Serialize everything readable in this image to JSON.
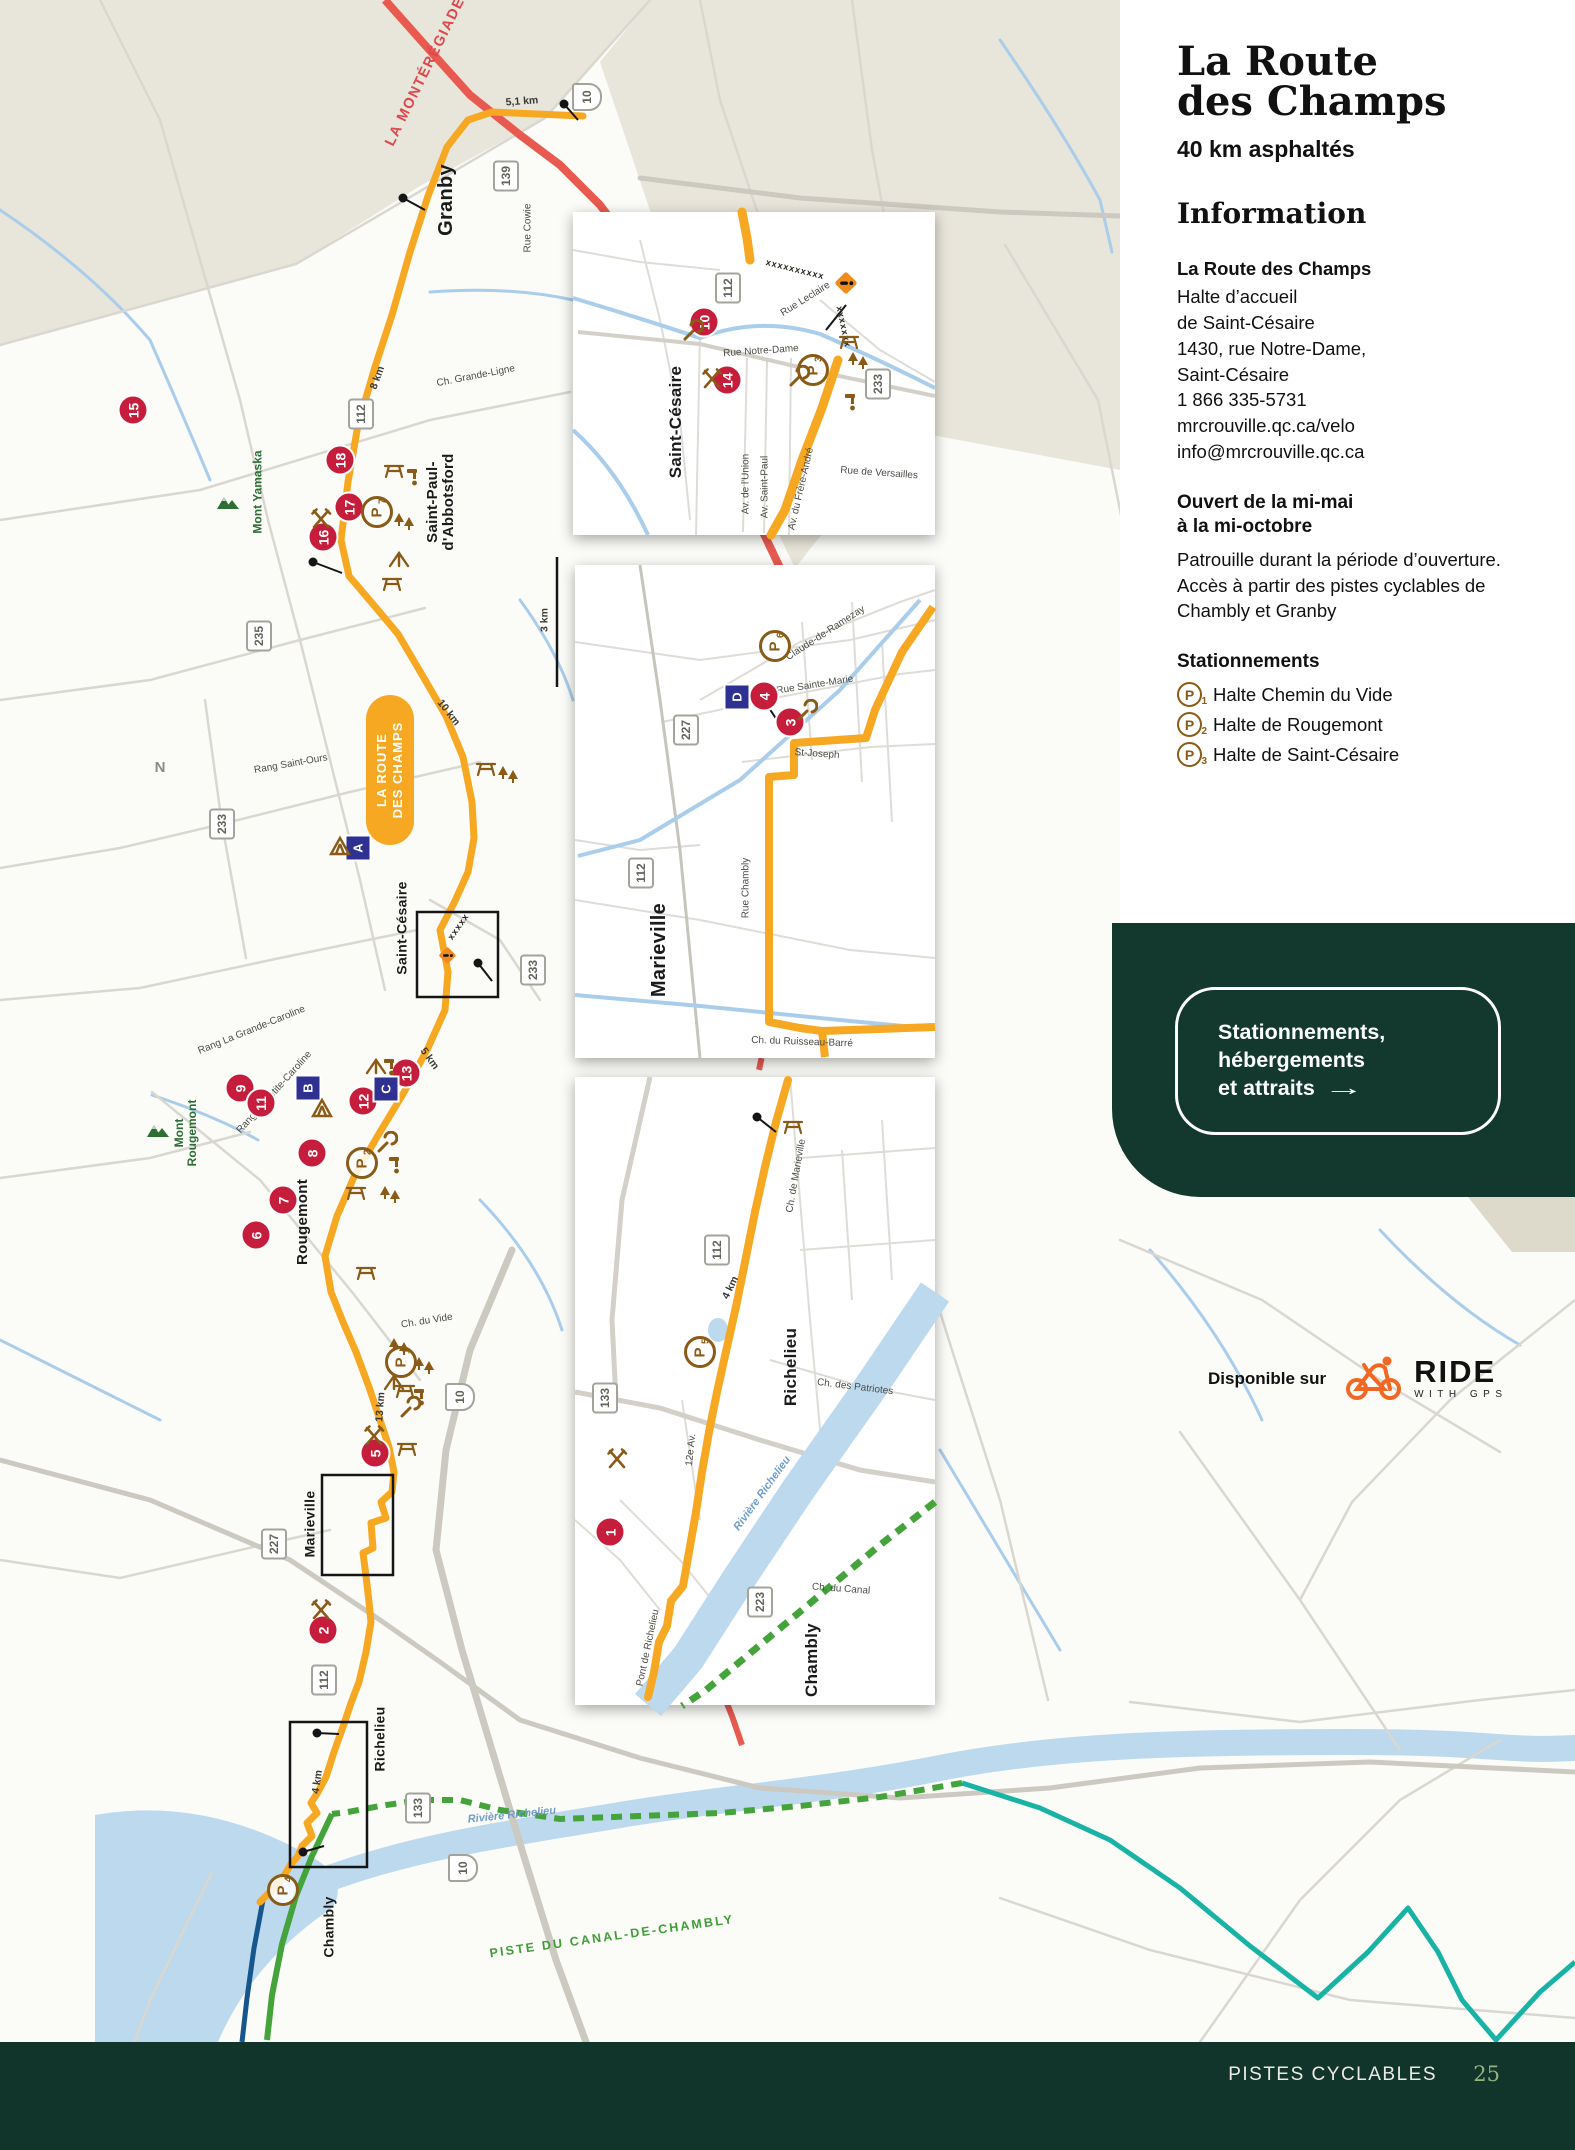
{
  "page": {
    "footer": {
      "section": "PISTES CYCLABLES",
      "page_number": "25"
    }
  },
  "panel": {
    "title": "La Route\ndes Champs",
    "subtitle": "40 km asphaltés",
    "info_heading": "Information",
    "info_name": "La Route des Champs",
    "address": "Halte d’accueil\nde Saint-Césaire\n1430, rue Notre-Dame,\nSaint-Césaire",
    "phone": "1 866 335-5731",
    "website": "mrcrouville.qc.ca/velo",
    "email": "info@mrcrouville.qc.ca",
    "open_heading": "Ouvert de la mi-mai\nà la mi-octobre",
    "open_body": "Patrouille durant la période d’ouverture. Accès à partir des pistes cyclables de Chambly et Granby",
    "parking_heading": "Stationnements",
    "parking_items": [
      {
        "num": "1",
        "label": "Halte Chemin du Vide"
      },
      {
        "num": "2",
        "label": "Halte de Rougemont"
      },
      {
        "num": "3",
        "label": "Halte de Saint-Césaire"
      }
    ],
    "cta": {
      "label": "Stationnements,\nhébergements\net attraits",
      "arrow": "→"
    },
    "ridewithgps": {
      "prefix": "Disponible sur",
      "brand": "RIDE",
      "sub": "WITH GPS"
    }
  },
  "map": {
    "badge": {
      "line1": "LA ROUTE",
      "line2": "DES CHAMPS"
    },
    "accent_colors": {
      "route_orange": "#f7a823",
      "monteregiade_red": "#e85a50",
      "canal_green": "#45a33c",
      "teal": "#19b3a6",
      "navy": "#17568c",
      "marker_red": "#c51d3b",
      "marker_blue": "#2e3192",
      "icon_brown": "#8a5a17",
      "dark_green": "#13382e"
    },
    "labels": [
      {
        "t": "LA MONTÉRÉGIADE",
        "x": 426,
        "y": 72,
        "r": -64,
        "c": "rlabel",
        "n": "route-label-monteregiade"
      },
      {
        "t": "PISTE DU CANAL-DE-CHAMBLY",
        "x": 612,
        "y": 1937,
        "r": -8,
        "c": "glabel",
        "n": "route-label-canal-chambly"
      },
      {
        "t": "Granby",
        "x": 447,
        "y": 200,
        "r": -90,
        "c": "city",
        "s": 20,
        "n": "city-granby"
      },
      {
        "t": "Saint-Paul-\nd'Abbotsford",
        "x": 441,
        "y": 502,
        "r": -90,
        "c": "city",
        "s": 15,
        "n": "city-saint-paul-abbotsford"
      },
      {
        "t": "Saint-Césaire",
        "x": 402,
        "y": 928,
        "r": -90,
        "c": "city",
        "s": 14,
        "n": "city-saint-cesaire"
      },
      {
        "t": "Rougemont",
        "x": 303,
        "y": 1222,
        "r": -90,
        "c": "city",
        "s": 15,
        "n": "city-rougemont"
      },
      {
        "t": "Marieville",
        "x": 310,
        "y": 1524,
        "r": -90,
        "c": "city",
        "s": 14,
        "n": "city-marieville"
      },
      {
        "t": "Richelieu",
        "x": 380,
        "y": 1739,
        "r": -90,
        "c": "city",
        "s": 14,
        "n": "city-richelieu"
      },
      {
        "t": "Chambly",
        "x": 329,
        "y": 1927,
        "r": -90,
        "c": "city",
        "s": 14,
        "n": "city-chambly"
      },
      {
        "t": "Saint-Césaire",
        "x": 676,
        "y": 422,
        "r": -90,
        "c": "city",
        "s": 17,
        "n": "inset1-city-saint-cesaire"
      },
      {
        "t": "Marieville",
        "x": 660,
        "y": 950,
        "r": -90,
        "c": "city",
        "s": 20,
        "n": "inset2-city-marieville"
      },
      {
        "t": "Richelieu",
        "x": 791,
        "y": 1367,
        "r": -90,
        "c": "city",
        "s": 17,
        "n": "inset3-city-richelieu"
      },
      {
        "t": "Chambly",
        "x": 812,
        "y": 1660,
        "r": -90,
        "c": "city",
        "s": 17,
        "n": "inset3-city-chambly"
      },
      {
        "t": "Mont Yamaska",
        "x": 258,
        "y": 492,
        "r": -90,
        "c": "mount",
        "n": "mont-yamaska-label"
      },
      {
        "t": "Mont\nRougemont",
        "x": 186,
        "y": 1133,
        "r": -90,
        "c": "mount",
        "n": "mont-rougemont-label"
      },
      {
        "t": "Rue Cowie",
        "x": 529,
        "y": 228,
        "r": -90,
        "c": "street"
      },
      {
        "t": "Ch. Grande-Ligne",
        "x": 476,
        "y": 377,
        "r": -11,
        "c": "street"
      },
      {
        "t": "Rang Saint-Ours",
        "x": 291,
        "y": 765,
        "r": -10,
        "c": "street"
      },
      {
        "t": "Rang La Grande-Caroline",
        "x": 252,
        "y": 1031,
        "r": -22,
        "c": "street"
      },
      {
        "t": "Rang La Petite-Caroline",
        "x": 275,
        "y": 1093,
        "r": -48,
        "c": "street"
      },
      {
        "t": "Ch. du Vide",
        "x": 427,
        "y": 1322,
        "r": -9,
        "c": "street"
      },
      {
        "t": "Rue Notre-Dame",
        "x": 761,
        "y": 352,
        "r": -4,
        "c": "street"
      },
      {
        "t": "Rue Leclaire",
        "x": 806,
        "y": 300,
        "r": -32,
        "c": "street"
      },
      {
        "t": "Av. de l'Union",
        "x": 747,
        "y": 484,
        "r": -90,
        "c": "street"
      },
      {
        "t": "Av. Saint-Paul",
        "x": 766,
        "y": 487,
        "r": -90,
        "c": "street"
      },
      {
        "t": "Av. du Frère-André",
        "x": 802,
        "y": 489,
        "r": -77,
        "c": "street"
      },
      {
        "t": "Rue de Versailles",
        "x": 879,
        "y": 474,
        "r": 4,
        "c": "street"
      },
      {
        "t": "Claude-de-Ramezay",
        "x": 826,
        "y": 634,
        "r": -33,
        "c": "street"
      },
      {
        "t": "Rue Sainte-Marie",
        "x": 815,
        "y": 686,
        "r": -9,
        "c": "street"
      },
      {
        "t": "St-Joseph",
        "x": 817,
        "y": 755,
        "r": 4,
        "c": "street"
      },
      {
        "t": "Rue Chambly",
        "x": 747,
        "y": 888,
        "r": -90,
        "c": "street"
      },
      {
        "t": "Ch. du Ruisseau-Barré",
        "x": 802,
        "y": 1043,
        "r": 2,
        "c": "street"
      },
      {
        "t": "Ch. de Marieville",
        "x": 797,
        "y": 1176,
        "r": -80,
        "c": "street"
      },
      {
        "t": "Ch. des Patriotes",
        "x": 855,
        "y": 1388,
        "r": 7,
        "c": "street"
      },
      {
        "t": "12e Av.",
        "x": 692,
        "y": 1450,
        "r": -84,
        "c": "street"
      },
      {
        "t": "Pont de Richelieu",
        "x": 649,
        "y": 1648,
        "r": -78,
        "c": "street"
      },
      {
        "t": "Ch. du Canal",
        "x": 841,
        "y": 1590,
        "r": 4,
        "c": "street"
      },
      {
        "t": "5,1 km",
        "x": 522,
        "y": 102,
        "r": -4,
        "c": "dist"
      },
      {
        "t": "8 km",
        "x": 378,
        "y": 378,
        "r": -70,
        "c": "dist"
      },
      {
        "t": "10 km",
        "x": 448,
        "y": 713,
        "r": 52,
        "c": "dist"
      },
      {
        "t": "3 km",
        "x": 545,
        "y": 620,
        "r": -90,
        "c": "dist"
      },
      {
        "t": "5 km",
        "x": 429,
        "y": 1059,
        "r": 54,
        "c": "dist"
      },
      {
        "t": "13 km",
        "x": 381,
        "y": 1407,
        "r": -86,
        "c": "dist"
      },
      {
        "t": "4 km",
        "x": 318,
        "y": 1782,
        "r": -82,
        "c": "dist"
      },
      {
        "t": "4 km",
        "x": 731,
        "y": 1288,
        "r": -64,
        "c": "dist"
      },
      {
        "t": "Rivière Richelieu",
        "x": 512,
        "y": 1816,
        "r": -6,
        "c": "water"
      },
      {
        "t": "Rivière Richelieu",
        "x": 763,
        "y": 1494,
        "r": -54,
        "c": "water"
      },
      {
        "t": "N",
        "x": 160,
        "y": 768,
        "r": 0,
        "c": "compass",
        "n": "compass-north"
      },
      {
        "t": "xxxxxxxxxx",
        "x": 795,
        "y": 270,
        "r": 14,
        "c": "xchain",
        "n": "construction-section"
      },
      {
        "t": "xxxxxxx",
        "x": 843,
        "y": 327,
        "r": 78,
        "c": "xchain",
        "n": "construction-section"
      },
      {
        "t": "xxxxx",
        "x": 459,
        "y": 927,
        "r": -55,
        "c": "xchain",
        "n": "construction-section"
      }
    ],
    "numbered_markers": [
      {
        "n": "1",
        "x": 610,
        "y": 1532
      },
      {
        "n": "2",
        "x": 323,
        "y": 1630
      },
      {
        "n": "3",
        "x": 790,
        "y": 722
      },
      {
        "n": "4",
        "x": 764,
        "y": 696
      },
      {
        "n": "5",
        "x": 375,
        "y": 1453
      },
      {
        "n": "6",
        "x": 256,
        "y": 1235
      },
      {
        "n": "7",
        "x": 283,
        "y": 1200
      },
      {
        "n": "8",
        "x": 312,
        "y": 1153
      },
      {
        "n": "9",
        "x": 240,
        "y": 1088
      },
      {
        "n": "10",
        "x": 704,
        "y": 322
      },
      {
        "n": "11",
        "x": 261,
        "y": 1103
      },
      {
        "n": "12",
        "x": 363,
        "y": 1101
      },
      {
        "n": "13",
        "x": 406,
        "y": 1073
      },
      {
        "n": "14",
        "x": 727,
        "y": 380
      },
      {
        "n": "15",
        "x": 133,
        "y": 410
      },
      {
        "n": "16",
        "x": 323,
        "y": 537
      },
      {
        "n": "17",
        "x": 349,
        "y": 507
      },
      {
        "n": "18",
        "x": 340,
        "y": 460
      }
    ],
    "letter_markers": [
      {
        "n": "A",
        "x": 358,
        "y": 848
      },
      {
        "n": "B",
        "x": 308,
        "y": 1088
      },
      {
        "n": "C",
        "x": 386,
        "y": 1089
      },
      {
        "n": "D",
        "x": 737,
        "y": 697
      }
    ],
    "parking_markers": [
      {
        "n": "1",
        "x": 401,
        "y": 1362
      },
      {
        "n": "2",
        "x": 362,
        "y": 1163
      },
      {
        "n": "3",
        "x": 813,
        "y": 370
      },
      {
        "n": "4",
        "x": 283,
        "y": 1890
      },
      {
        "n": "5",
        "x": 700,
        "y": 1352
      },
      {
        "n": "6",
        "x": 775,
        "y": 646
      },
      {
        "n": "7",
        "x": 377,
        "y": 512
      }
    ],
    "shields": [
      {
        "t": "139",
        "x": 506,
        "y": 176
      },
      {
        "t": "112",
        "x": 361,
        "y": 414
      },
      {
        "t": "235",
        "x": 259,
        "y": 636
      },
      {
        "t": "233",
        "x": 222,
        "y": 824
      },
      {
        "t": "233",
        "x": 533,
        "y": 970
      },
      {
        "t": "112",
        "x": 324,
        "y": 1680
      },
      {
        "t": "227",
        "x": 274,
        "y": 1544
      },
      {
        "t": "133",
        "x": 418,
        "y": 1808
      },
      {
        "t": "112",
        "x": 728,
        "y": 288
      },
      {
        "t": "233",
        "x": 878,
        "y": 384
      },
      {
        "t": "227",
        "x": 686,
        "y": 730
      },
      {
        "t": "112",
        "x": 641,
        "y": 873
      },
      {
        "t": "112",
        "x": 717,
        "y": 1250
      },
      {
        "t": "133",
        "x": 605,
        "y": 1398
      },
      {
        "t": "223",
        "x": 760,
        "y": 1602
      },
      {
        "t": "10",
        "x": 587,
        "y": 97,
        "auto": true
      },
      {
        "t": "10",
        "x": 460,
        "y": 1397,
        "auto": true
      },
      {
        "t": "10",
        "x": 463,
        "y": 1868,
        "auto": true
      }
    ],
    "icons": [
      {
        "k": "food",
        "x": 321,
        "y": 519
      },
      {
        "k": "food",
        "x": 712,
        "y": 379
      },
      {
        "k": "food",
        "x": 374,
        "y": 1436
      },
      {
        "k": "food",
        "x": 321,
        "y": 1610
      },
      {
        "k": "food",
        "x": 617,
        "y": 1459
      },
      {
        "k": "wrench",
        "x": 692,
        "y": 331
      },
      {
        "k": "wrench",
        "x": 798,
        "y": 377
      },
      {
        "k": "wrench",
        "x": 806,
        "y": 711
      },
      {
        "k": "wrench",
        "x": 386,
        "y": 1143
      },
      {
        "k": "wrench",
        "x": 409,
        "y": 1408
      },
      {
        "k": "picnic",
        "x": 394,
        "y": 470
      },
      {
        "k": "picnic",
        "x": 392,
        "y": 583
      },
      {
        "k": "picnic",
        "x": 486,
        "y": 768
      },
      {
        "k": "picnic",
        "x": 366,
        "y": 1272
      },
      {
        "k": "picnic",
        "x": 356,
        "y": 1192
      },
      {
        "k": "picnic",
        "x": 405,
        "y": 1390
      },
      {
        "k": "picnic",
        "x": 407,
        "y": 1448
      },
      {
        "k": "picnic",
        "x": 849,
        "y": 341
      },
      {
        "k": "picnic",
        "x": 793,
        "y": 1126
      },
      {
        "k": "trees",
        "x": 404,
        "y": 523
      },
      {
        "k": "trees",
        "x": 508,
        "y": 776
      },
      {
        "k": "trees",
        "x": 390,
        "y": 1196
      },
      {
        "k": "trees",
        "x": 399,
        "y": 1348
      },
      {
        "k": "trees",
        "x": 424,
        "y": 1367
      },
      {
        "k": "trees",
        "x": 858,
        "y": 362
      },
      {
        "k": "tent",
        "x": 340,
        "y": 846
      },
      {
        "k": "tent",
        "x": 322,
        "y": 1108
      },
      {
        "k": "shelter",
        "x": 399,
        "y": 559
      },
      {
        "k": "shelter",
        "x": 376,
        "y": 1066
      },
      {
        "k": "shelter",
        "x": 394,
        "y": 1382
      },
      {
        "k": "water",
        "x": 414,
        "y": 476
      },
      {
        "k": "water",
        "x": 396,
        "y": 1164
      },
      {
        "k": "water",
        "x": 421,
        "y": 1396
      },
      {
        "k": "water",
        "x": 852,
        "y": 401
      },
      {
        "k": "water",
        "x": 391,
        "y": 1066
      },
      {
        "k": "construction",
        "x": 846,
        "y": 283,
        "s": 1.25
      },
      {
        "k": "construction",
        "x": 447,
        "y": 955,
        "s": 0.95
      },
      {
        "k": "mountain",
        "x": 228,
        "y": 505
      },
      {
        "k": "mountain",
        "x": 158,
        "y": 1133
      }
    ]
  }
}
